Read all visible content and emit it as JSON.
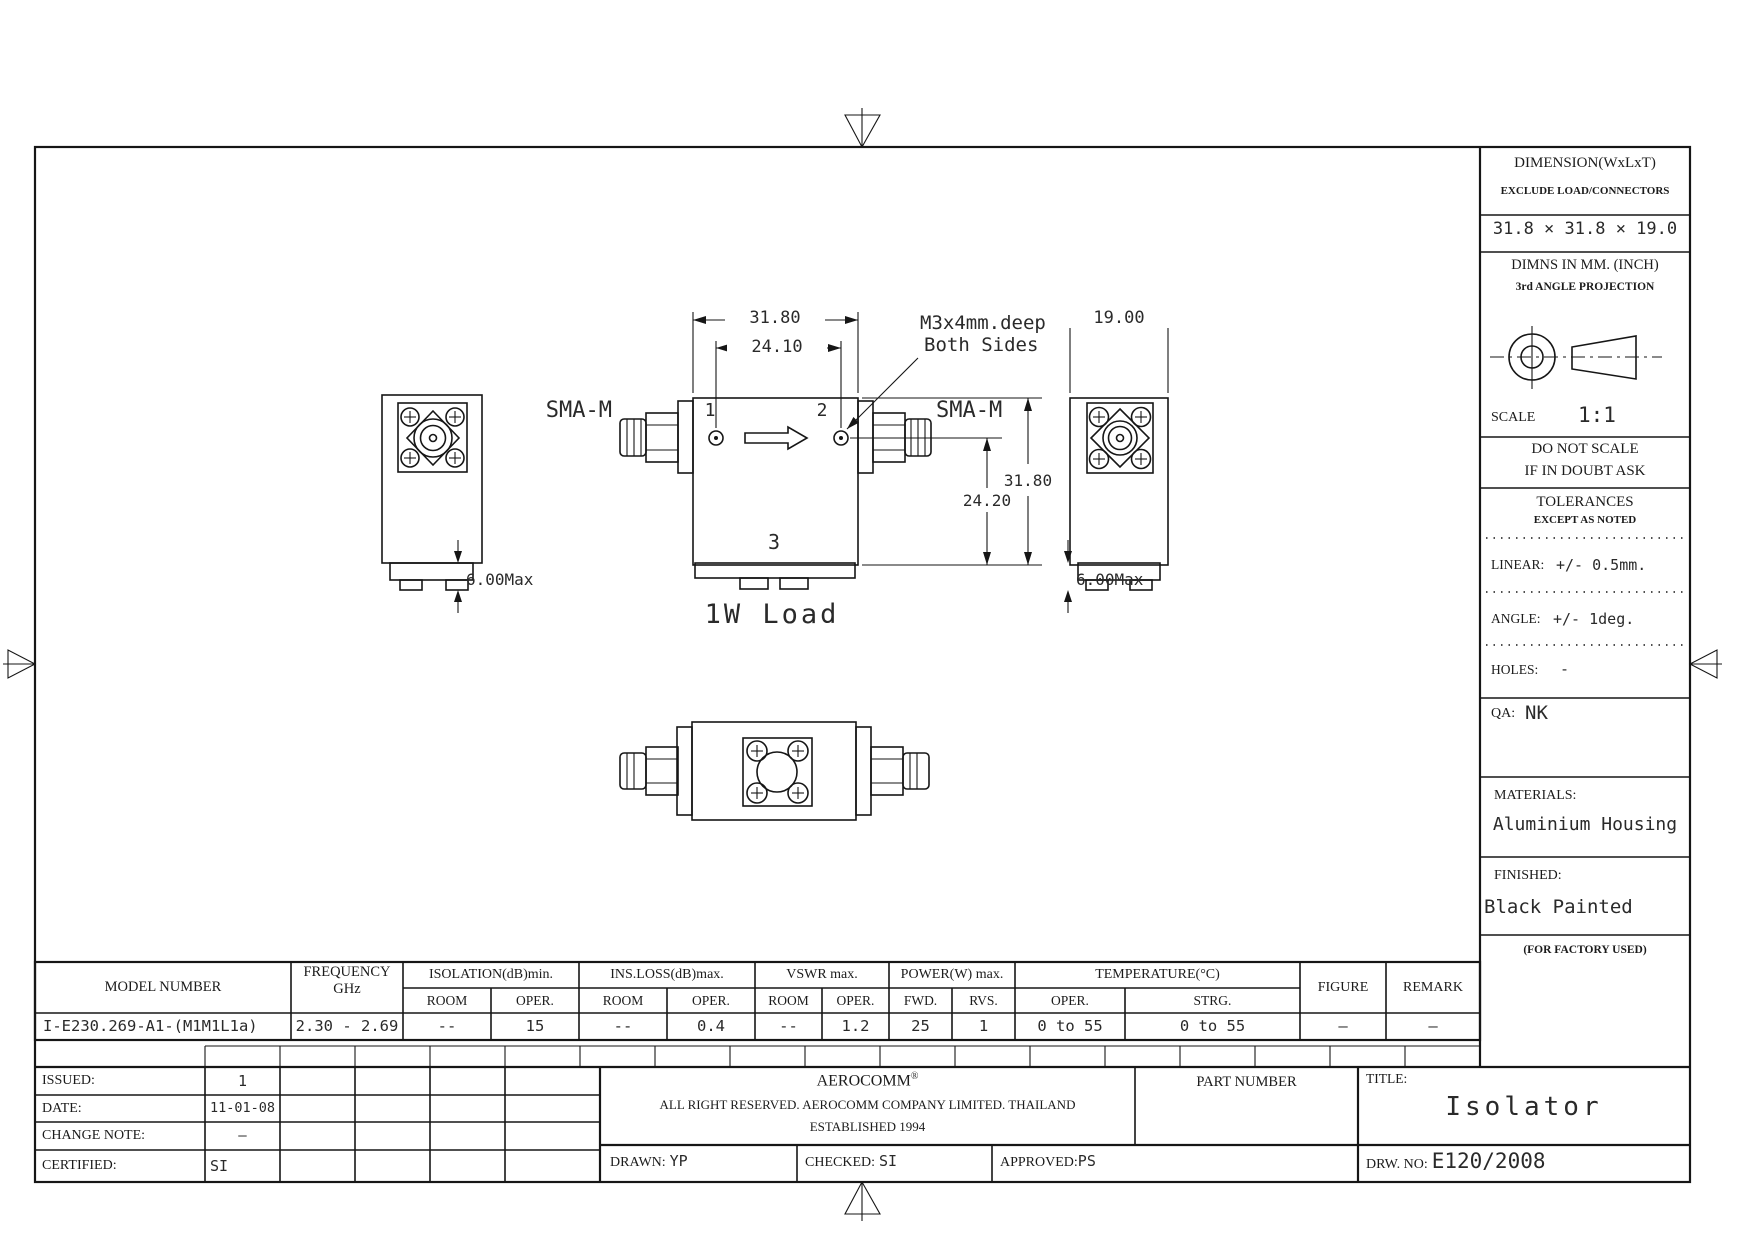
{
  "sidebar": {
    "dimension": {
      "title": "DIMENSION(WxLxT)",
      "subtitle": "EXCLUDE LOAD/CONNECTORS",
      "value": "31.8 × 31.8 × 19.0"
    },
    "units": {
      "line1": "DIMNS IN MM. (INCH)",
      "line2": "3rd ANGLE PROJECTION"
    },
    "scale": {
      "label": "SCALE",
      "value": "1:1"
    },
    "warning": {
      "line1": "DO NOT SCALE",
      "line2": "IF IN DOUBT ASK"
    },
    "tolerances": {
      "title": "TOLERANCES",
      "subtitle": "EXCEPT AS NOTED",
      "linear_label": "LINEAR:",
      "linear_value": "+/- 0.5mm.",
      "angle_label": "ANGLE:",
      "angle_value": "+/- 1deg.",
      "holes_label": "HOLES:",
      "holes_value": "-"
    },
    "qa": {
      "label": "QA:",
      "value": "NK"
    },
    "materials": {
      "label": "MATERIALS:",
      "value": "Aluminium Housing"
    },
    "finished": {
      "label": "FINISHED:",
      "value": "Black Painted"
    },
    "factory_note": "(FOR FACTORY USED)"
  },
  "drawing": {
    "dim_width": "31.80",
    "dim_hole_spacing": "24.10",
    "dim_depth": "19.00",
    "dim_height": "31.80",
    "dim_port_height": "24.20",
    "dim_base_left": "6.00Max",
    "dim_base_right": "6.00Max",
    "connector_left": "SMA-M",
    "connector_right": "SMA-M",
    "port1": "1",
    "port2": "2",
    "port3": "3",
    "load_label": "1W Load",
    "note_line1": "M3x4mm.deep",
    "note_line2": "Both Sides"
  },
  "spec_table": {
    "headers": {
      "model": "MODEL NUMBER",
      "frequency_line1": "FREQUENCY",
      "frequency_line2": "GHz",
      "isolation": "ISOLATION(dB)min.",
      "ins_loss": "INS.LOSS(dB)max.",
      "vswr": "VSWR max.",
      "power": "POWER(W) max.",
      "temperature": "TEMPERATURE(°C)",
      "figure": "FIGURE",
      "remark": "REMARK",
      "room": "ROOM",
      "oper": "OPER.",
      "fwd": "FWD.",
      "rvs": "RVS.",
      "strg": "STRG."
    },
    "row": {
      "model": "I-E230.269-A1-(M1M1L1a)",
      "frequency": "2.30 - 2.69",
      "isolation_room": "--",
      "isolation_oper": "15",
      "ins_loss_room": "--",
      "ins_loss_oper": "0.4",
      "vswr_room": "--",
      "vswr_oper": "1.2",
      "power_fwd": "25",
      "power_rvs": "1",
      "temp_oper": "0 to 55",
      "temp_strg": "0 to 55",
      "figure": "—",
      "remark": "—"
    }
  },
  "title_block": {
    "issued_label": "ISSUED:",
    "issued_value": "1",
    "date_label": "DATE:",
    "date_value": "11-01-08",
    "change_note_label": "CHANGE NOTE:",
    "change_note_value": "—",
    "certified_label": "CERTIFIED:",
    "certified_value": "SI",
    "company_name": "AEROCOMM",
    "company_reg": "®",
    "company_line2": "ALL RIGHT RESERVED. AEROCOMM COMPANY LIMITED. THAILAND",
    "company_line3": "ESTABLISHED 1994",
    "part_number_label": "PART NUMBER",
    "title_label": "TITLE:",
    "title_value": "Isolator",
    "drawn_label": "DRAWN:",
    "drawn_value": "YP",
    "checked_label": "CHECKED:",
    "checked_value": "SI",
    "approved_label": "APPROVED:",
    "approved_value": "PS",
    "drw_no_label": "DRW. NO:",
    "drw_no_value": "E120/2008"
  }
}
